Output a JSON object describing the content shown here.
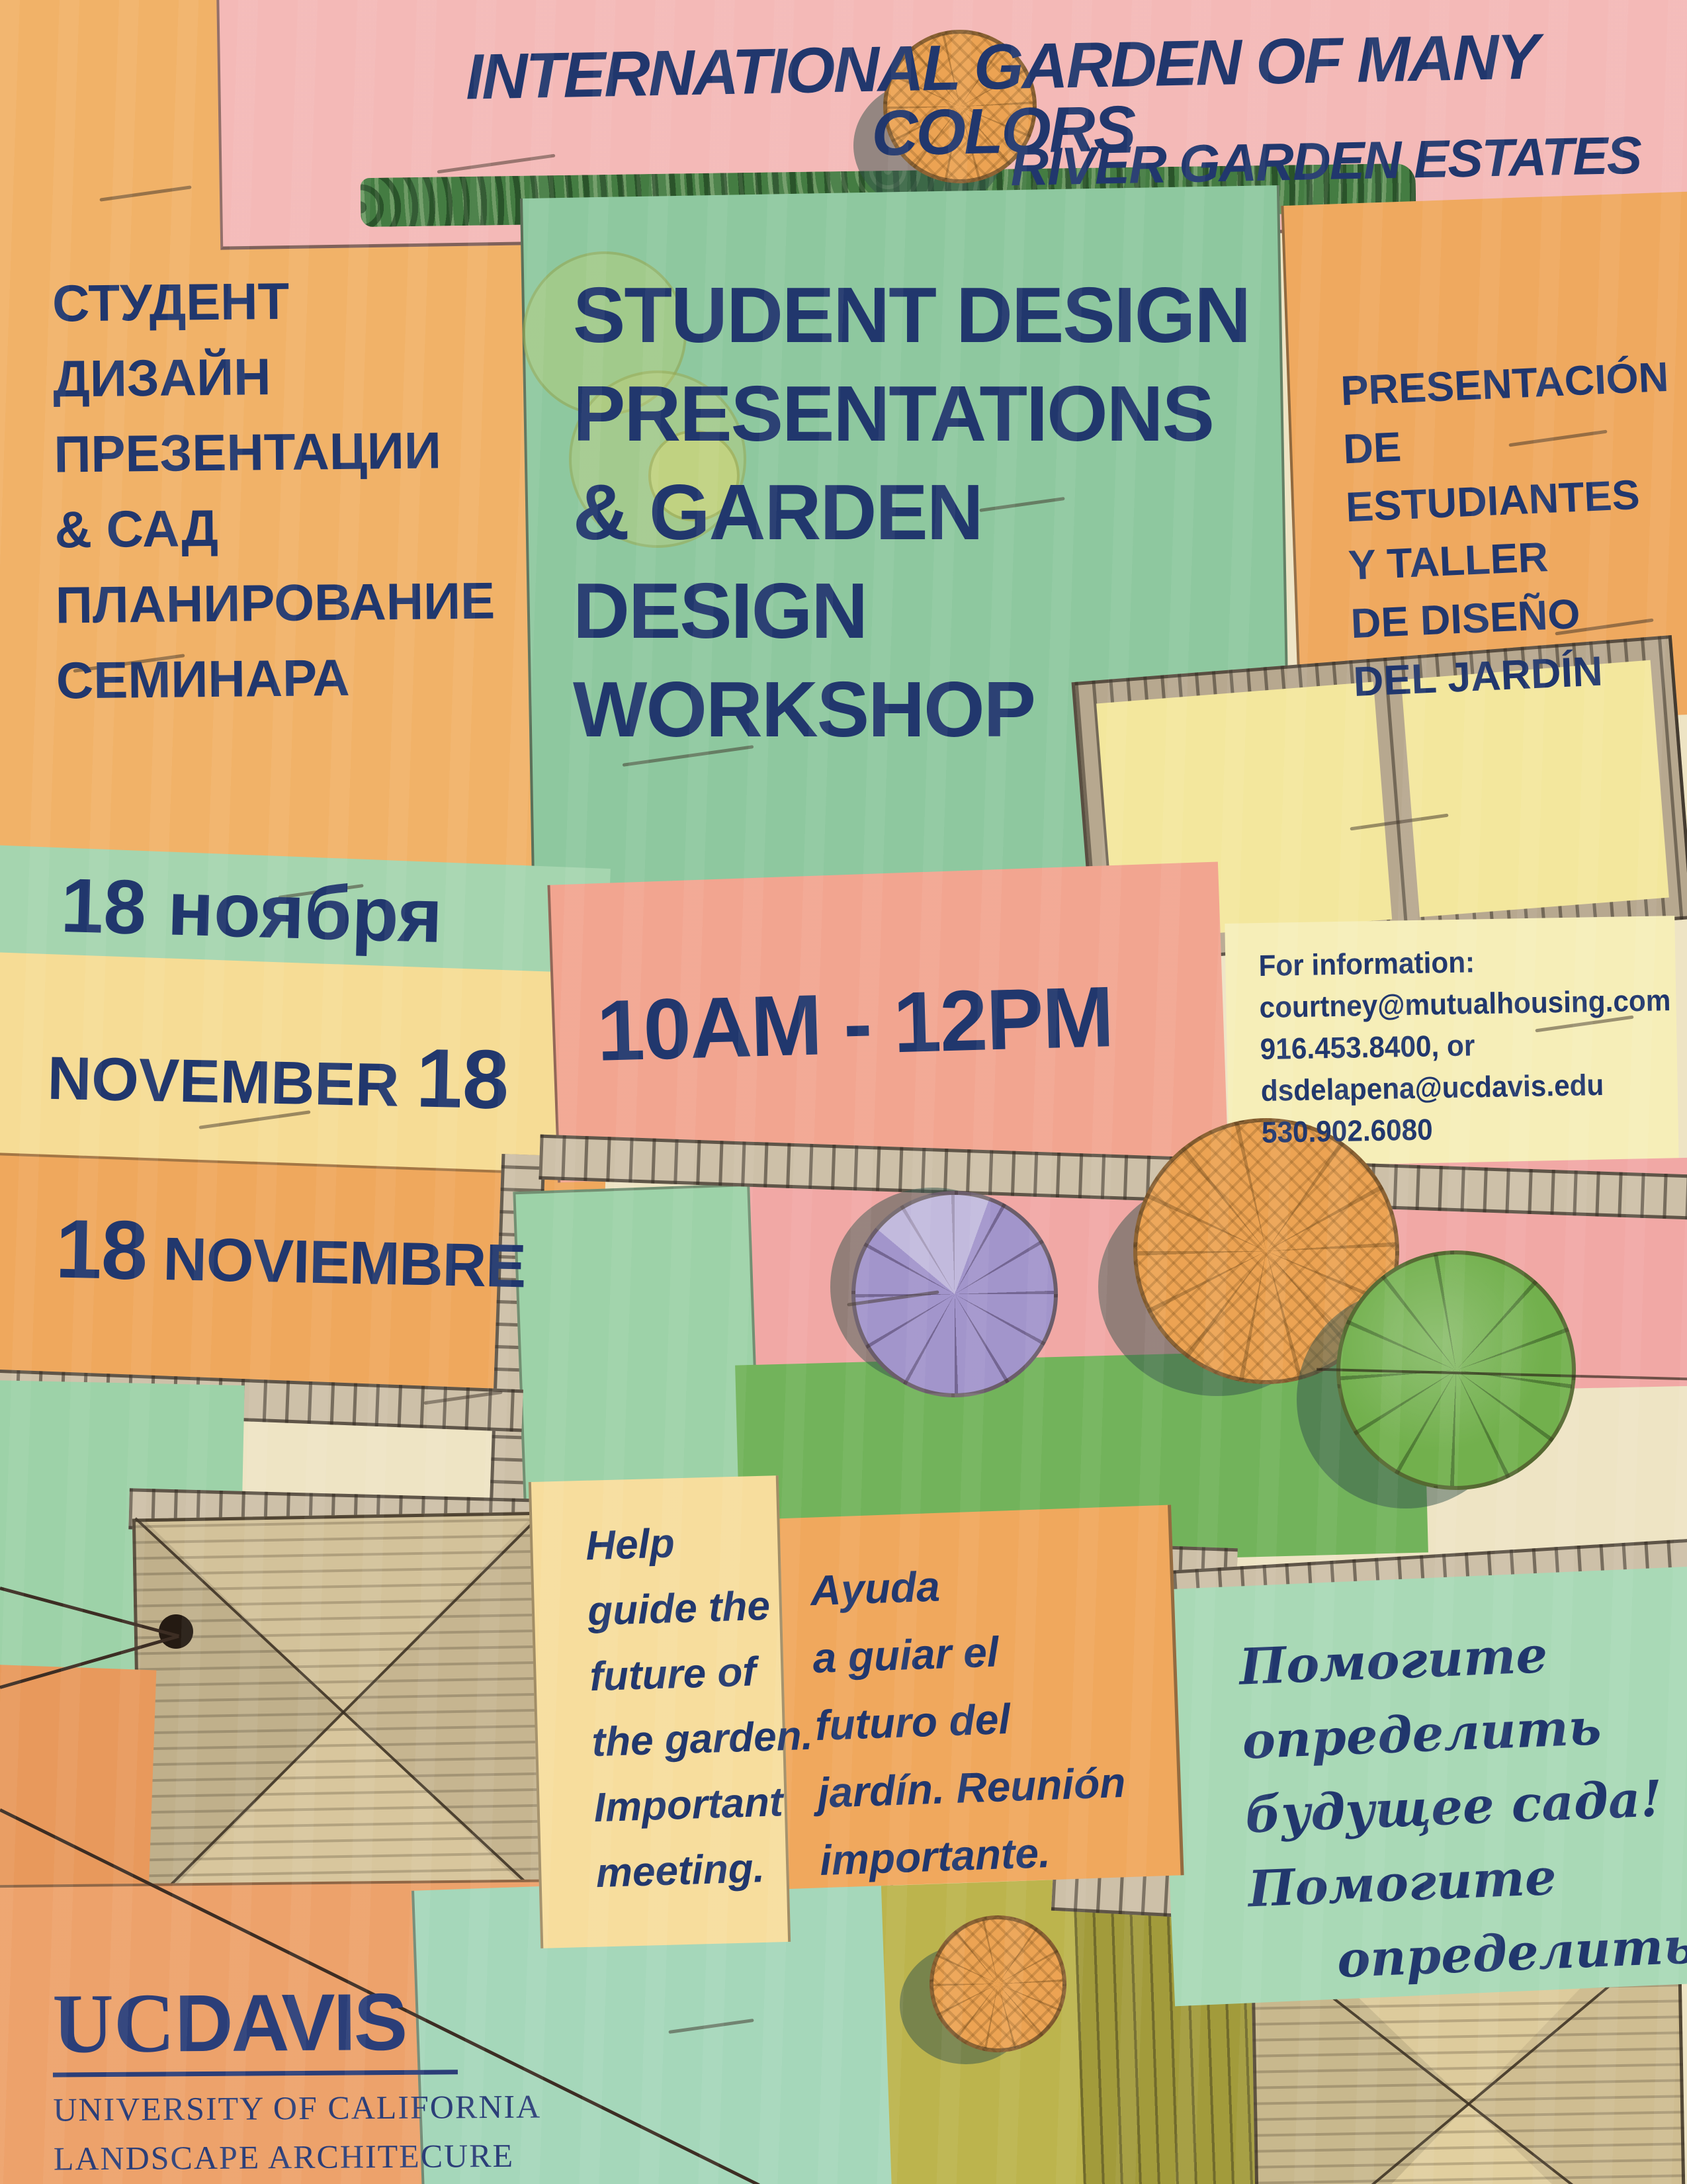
{
  "poster": {
    "header": {
      "title": "INTERNATIONAL GARDEN OF MANY COLORS",
      "subtitle": "RIVER GARDEN ESTATES"
    },
    "title_block_ru": {
      "lines": [
        "СТУДЕНТ",
        "ДИЗАЙН",
        "ПРЕЗЕНТАЦИИ",
        "& САД",
        "ПЛАНИРОВАНИЕ",
        "СЕМИНАРА"
      ]
    },
    "title_block_en": {
      "lines": [
        "STUDENT DESIGN",
        "PRESENTATIONS",
        "& GARDEN",
        "DESIGN",
        "WORKSHOP"
      ]
    },
    "title_block_es": {
      "lines": [
        "PRESENTACIÓN",
        "DE ESTUDIANTES",
        "Y TALLER",
        "DE DISEÑO",
        "DEL JARDÍN"
      ]
    },
    "date_ru": "18 ноября",
    "date_en": {
      "month": "NOVEMBER",
      "day": "18"
    },
    "date_es": {
      "day": "18",
      "month": "NOVIEMBRE"
    },
    "time": "10AM - 12PM",
    "contact": {
      "lines": [
        "For information:",
        "courtney@mutualhousing.com",
        "916.453.8400, or",
        "dsdelapena@ucdavis.edu",
        "530.902.6080"
      ]
    },
    "message_en": {
      "lines": [
        "Help",
        "guide the",
        "future of",
        "the garden.",
        "Important",
        "meeting."
      ]
    },
    "message_es": {
      "lines": [
        "Ayuda",
        "a guiar el",
        "futuro del",
        "jardín. Reunión",
        "importante."
      ]
    },
    "message_ru": {
      "lines": [
        "Помогите",
        "определить",
        "будущее сада!",
        "Помогите",
        "определить"
      ]
    },
    "logo": {
      "uc": "UC",
      "davis": "DAVIS",
      "university": "UNIVERSITY OF CALIFORNIA",
      "department": "LANDSCAPE ARCHITECURE"
    }
  },
  "colors": {
    "navy": "#21376d",
    "banner_pink": "#f4b9b7",
    "orange": "#f0ac63",
    "green": "#8ec89f",
    "date_green": "#a5d5af",
    "date_yellow": "#f6dc95",
    "date_orange": "#efa85d",
    "salmon": "#f2a590",
    "info_yellow": "#f6eeb8",
    "pink_path": "#f1a8a5",
    "mint": "#a5d7ba"
  }
}
